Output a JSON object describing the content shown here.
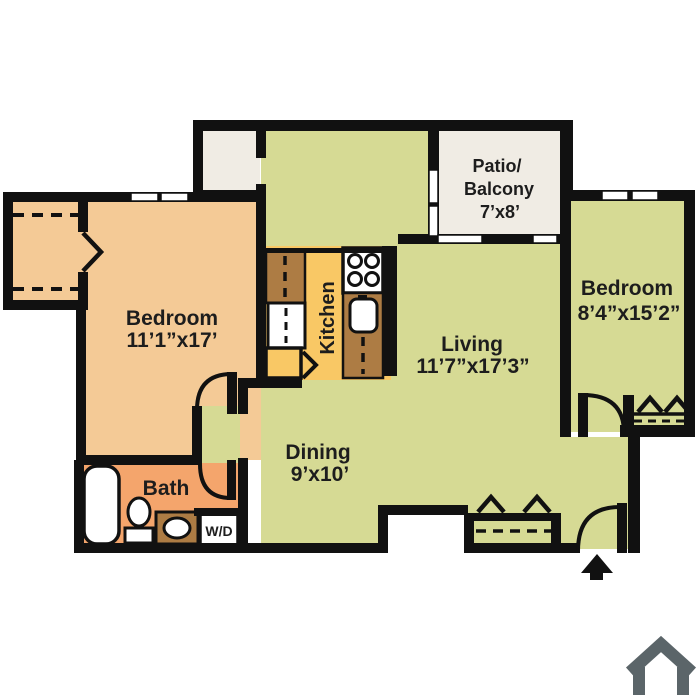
{
  "title": "Two bedroom apartment floor plan",
  "colors": {
    "wall": "#111111",
    "bedroom_fill": "#f4ca96",
    "bath_fill": "#f4a56c",
    "kitchen_floor": "#f9c865",
    "counter": "#ad7c44",
    "living_fill": "#d6da94",
    "patio_fill": "#f0ece4",
    "house_icon": "#5b6569",
    "label_text": "#1d1d1d"
  },
  "rooms": {
    "bedroom_left": {
      "name": "Bedroom",
      "dims": "11’1”x17’"
    },
    "living": {
      "name": "Living",
      "dims": "11’7”x17’3”"
    },
    "dining": {
      "name": "Dining",
      "dims": "9’x10’"
    },
    "bedroom_right": {
      "name": "Bedroom",
      "dims": "8’4”x15’2”"
    },
    "patio": {
      "line1": "Patio/",
      "line2": "Balcony",
      "dims": "7’x8’"
    },
    "kitchen": {
      "name": "Kitchen"
    },
    "bath": {
      "name": "Bath"
    },
    "laundry": {
      "label": "W/D"
    }
  },
  "icons": {
    "entry_arrow": "entry-arrow-icon",
    "house": "house-icon"
  }
}
